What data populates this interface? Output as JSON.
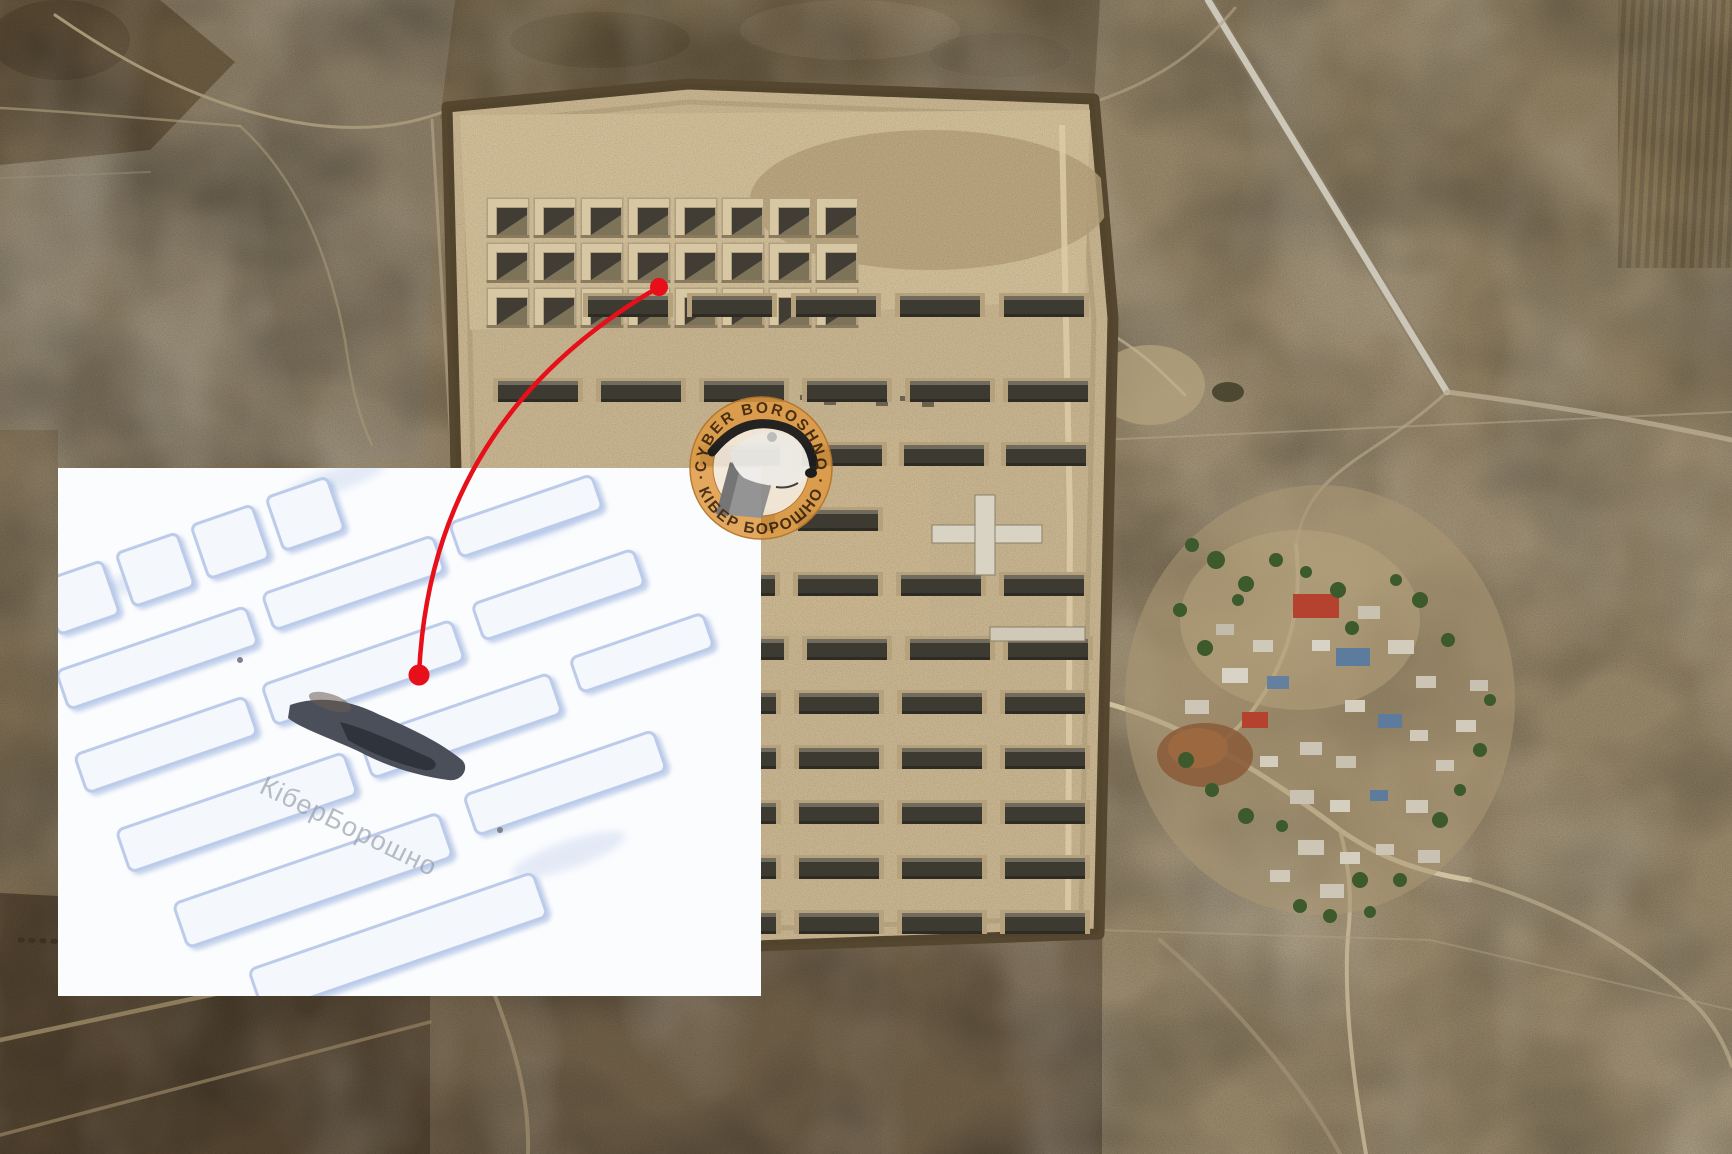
{
  "logo": {
    "icon": "badger-head-icon",
    "top_text": "CYBER BOROSHNO",
    "bottom_text": "· КІБЕР БОРОШНО ·",
    "ring_color": "#DF9A43",
    "text_color": "#42290D"
  },
  "inset": {
    "watermark": "КіберБорошно",
    "watermark_color": "#8F96A1"
  },
  "annotation": {
    "color": "#E60F1A",
    "source_marker": {
      "cx": 659,
      "cy": 287,
      "r": 9
    },
    "target_marker": {
      "cx": 419,
      "cy": 675,
      "r": 10.5
    }
  }
}
